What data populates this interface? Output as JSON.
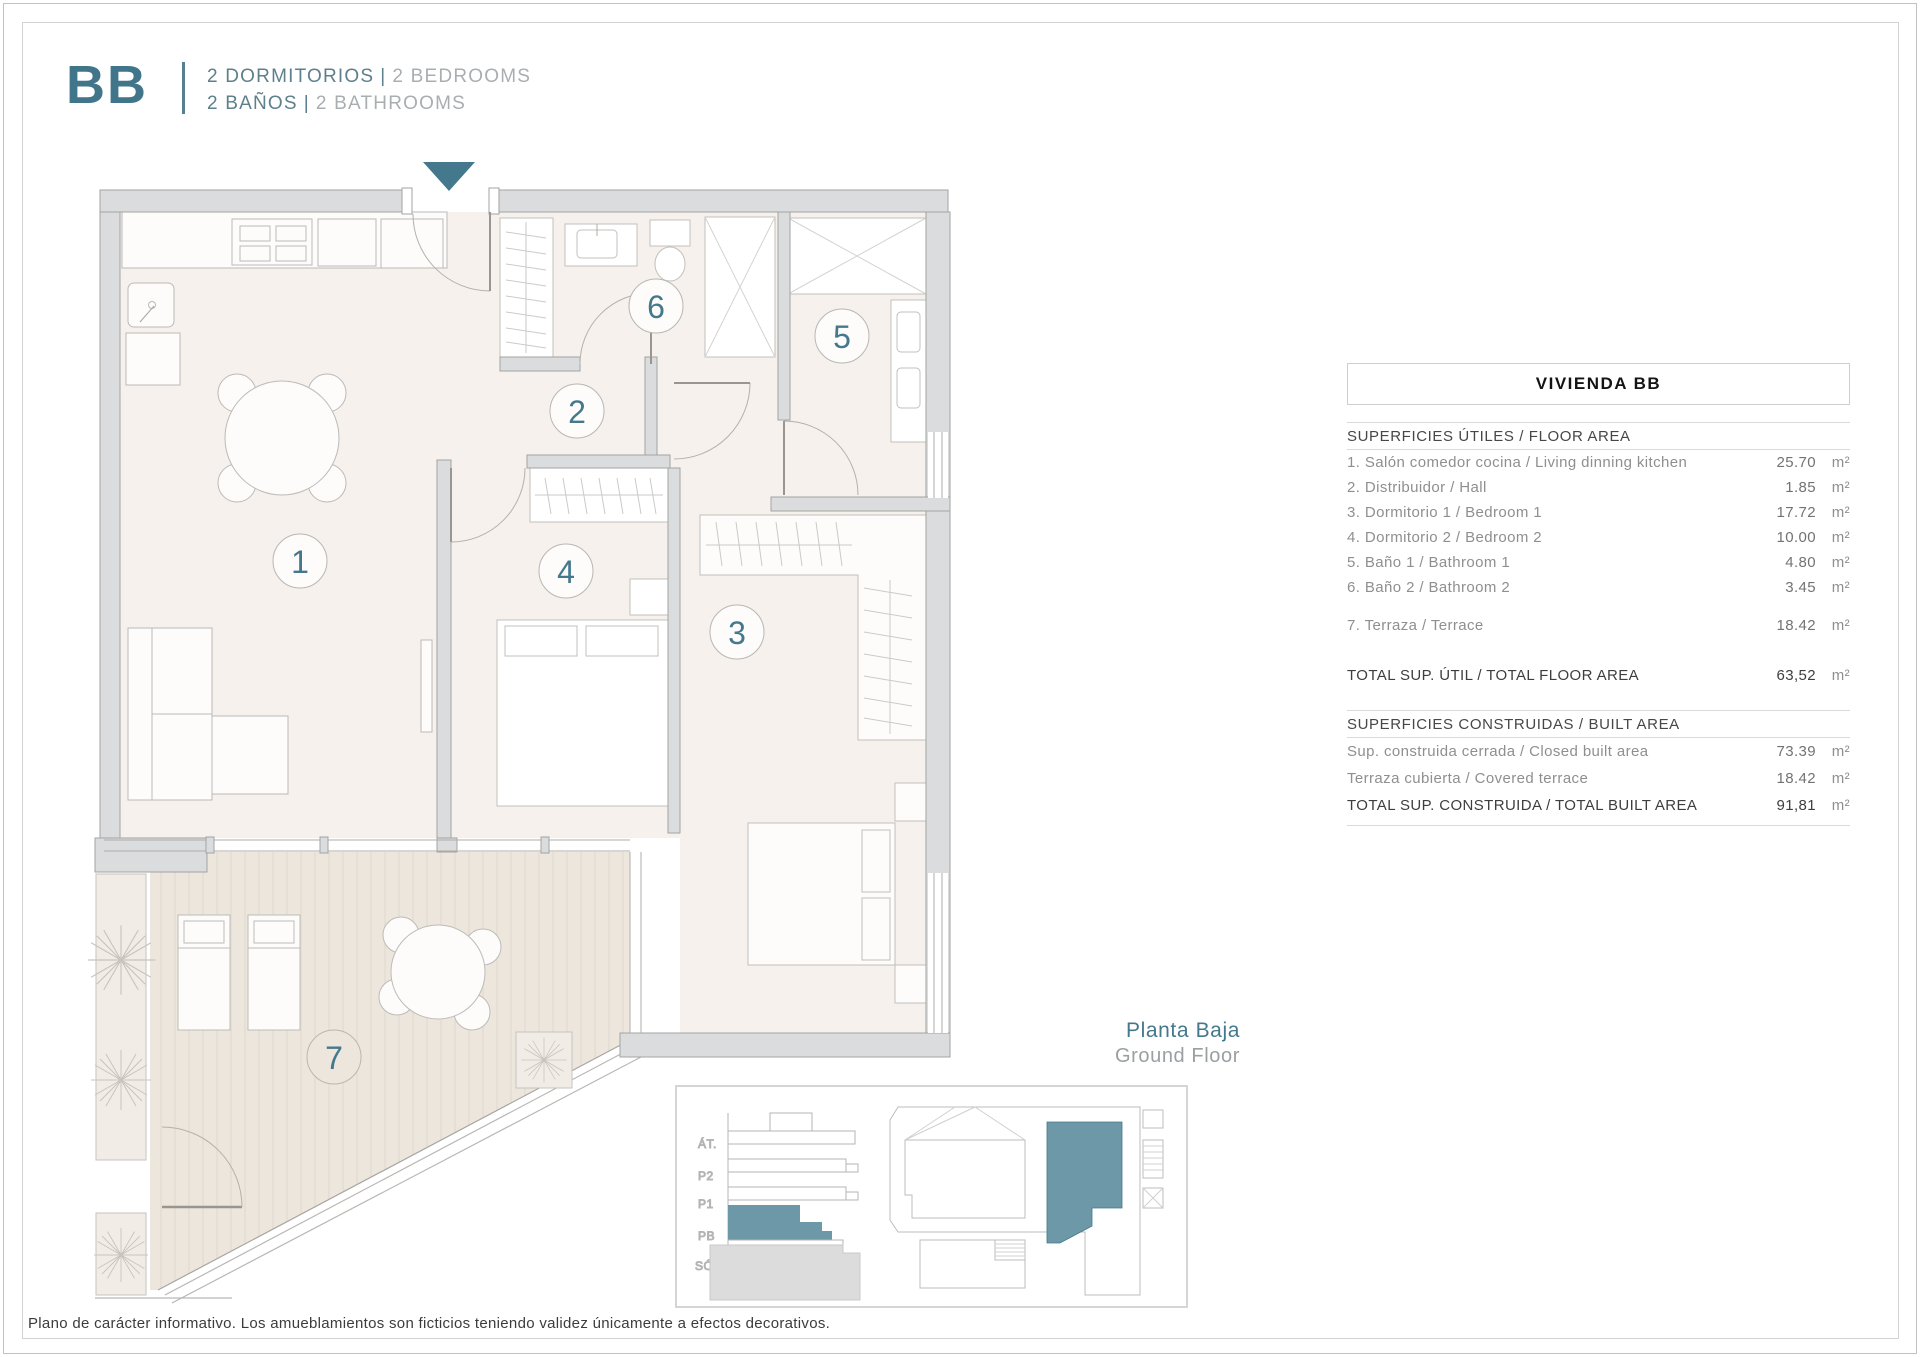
{
  "header": {
    "logo": "BB",
    "line1": {
      "primary": "2 DORMITORIOS",
      "sep": "|",
      "secondary": "2 BEDROOMS"
    },
    "line2": {
      "primary": "2 BAÑOS",
      "sep": "|",
      "secondary": "2 BATHROOMS"
    }
  },
  "colors": {
    "teal": "#44788c",
    "teal_light": "#6d98a8",
    "wall_gray": "#dbdcdd",
    "room_beige": "#f6f1ec",
    "deck_beige": "#ece6dd"
  },
  "plan": {
    "rooms": [
      "1",
      "2",
      "3",
      "4",
      "5",
      "6",
      "7"
    ],
    "entrance_icon": "down-arrow"
  },
  "table": {
    "title": "VIVIENDA BB",
    "floor_area": {
      "header": "SUPERFICIES ÚTILES / FLOOR AREA",
      "rows": [
        {
          "label": "1. Salón comedor cocina / Living dinning kitchen",
          "value": "25.70",
          "unit": "m²"
        },
        {
          "label": "2. Distribuidor / Hall",
          "value": "1.85",
          "unit": "m²"
        },
        {
          "label": "3. Dormitorio 1 / Bedroom 1",
          "value": "17.72",
          "unit": "m²"
        },
        {
          "label": "4. Dormitorio 2 / Bedroom 2",
          "value": "10.00",
          "unit": "m²"
        },
        {
          "label": "5. Baño 1 / Bathroom 1",
          "value": "4.80",
          "unit": "m²"
        },
        {
          "label": "6. Baño 2 / Bathroom 2",
          "value": "3.45",
          "unit": "m²"
        }
      ],
      "terrace_row": {
        "label": "7. Terraza / Terrace",
        "value": "18.42",
        "unit": "m²"
      },
      "total": {
        "label": "TOTAL SUP. ÚTIL / TOTAL FLOOR AREA",
        "value": "63,52",
        "unit": "m²"
      }
    },
    "built_area": {
      "header": "SUPERFICIES CONSTRUIDAS / BUILT AREA",
      "rows": [
        {
          "label": "Sup. construida cerrada / Closed built area",
          "value": "73.39",
          "unit": "m²"
        },
        {
          "label": "Terraza cubierta / Covered terrace",
          "value": "18.42",
          "unit": "m²"
        }
      ],
      "total": {
        "label": "TOTAL SUP. CONSTRUIDA /  TOTAL BUILT AREA",
        "value": "91,81",
        "unit": "m²"
      }
    }
  },
  "floor_label": {
    "es": "Planta Baja",
    "en": "Ground Floor"
  },
  "mini_diagram": {
    "levels": [
      "ÁT.",
      "P2",
      "P1",
      "PB",
      "SÓT."
    ]
  },
  "disclaimer": "Plano de carácter informativo. Los amueblamientos son ficticios teniendo validez únicamente a efectos decorativos."
}
